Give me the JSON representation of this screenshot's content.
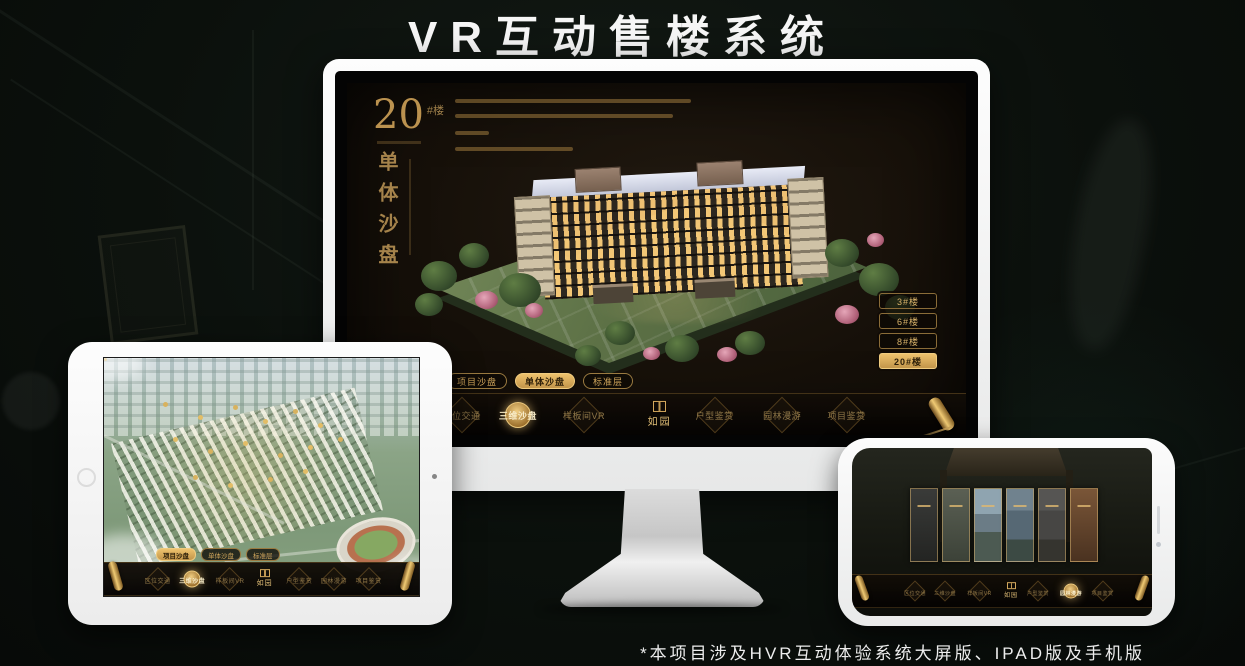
{
  "page": {
    "title": "VR互动售楼系统",
    "footnote": "*本项目涉及HVR互动体验系统大屏版、IPAD版及手机版"
  },
  "colors": {
    "gold": "#c9a063",
    "gold_bright": "#eec26d",
    "screen_bg": "#16110c",
    "device_white": "#f4f4f4"
  },
  "nav": {
    "logo": "如园",
    "subtabs": [
      {
        "label": "项目沙盘"
      },
      {
        "label": "单体沙盘"
      },
      {
        "label": "标准层"
      }
    ],
    "items": [
      {
        "label": "区位交通"
      },
      {
        "label": "三维沙盘"
      },
      {
        "label": "样板间VR"
      },
      {
        "label": "户型鉴赏"
      },
      {
        "label": "园林漫游"
      },
      {
        "label": "项目鉴赏"
      }
    ]
  },
  "monitor": {
    "heading": {
      "number": "20",
      "suffix": "#楼",
      "vertical": "单体沙盘"
    },
    "floor_buttons": [
      {
        "label": "3#楼",
        "active": false
      },
      {
        "label": "6#楼",
        "active": false
      },
      {
        "label": "8#楼",
        "active": false
      },
      {
        "label": "20#楼",
        "active": true
      }
    ],
    "active_subtab": "单体沙盘",
    "active_nav_item": "三维沙盘"
  },
  "tablet": {
    "active_subtab": "项目沙盘",
    "active_nav_item": "三维沙盘"
  },
  "phone": {
    "active_nav_item": "园林漫游"
  }
}
